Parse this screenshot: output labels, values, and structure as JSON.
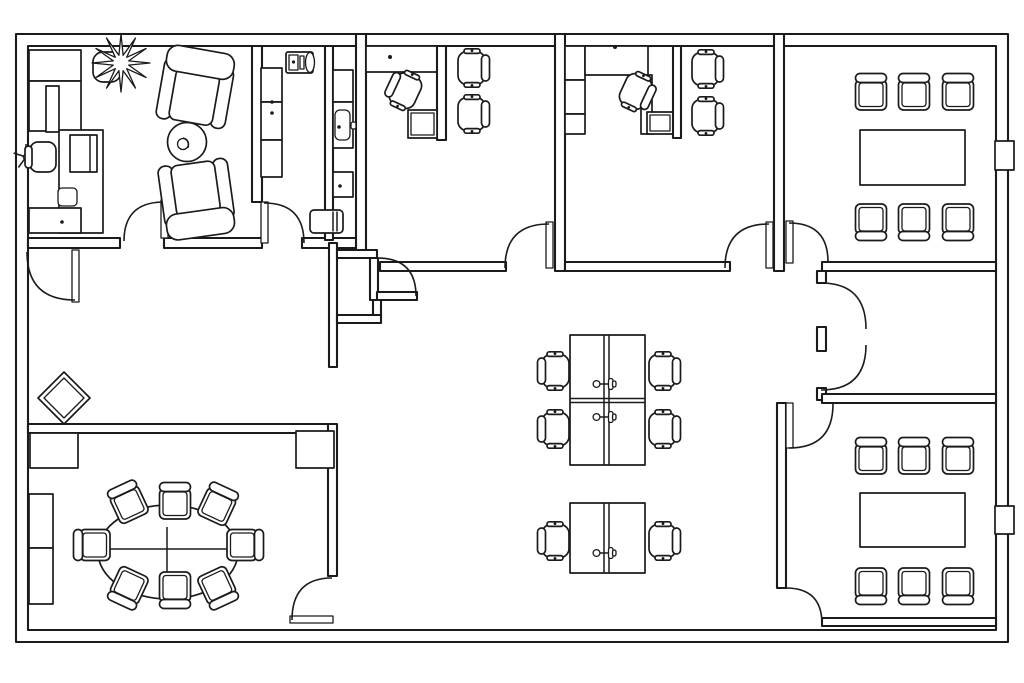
{
  "page": {
    "title": "Office floor plan",
    "type": "architectural-floor-plan",
    "background_color": "#ffffff",
    "line_color": "#1b1b1b",
    "canvas": {
      "width": 1024,
      "height": 683
    }
  },
  "floor_plan": {
    "style": "black and white CAD top-view drawing, hollow double-line walls, quarter-circle door swings",
    "total_doors": 12,
    "rooms": [
      {
        "id": "reception-office",
        "label": "Private office / reception (top-left)",
        "furniture": [
          {
            "type": "storage-cabinet",
            "count": 4
          },
          {
            "type": "reception-desk",
            "count": 1
          },
          {
            "type": "desk-chair-with-star-base",
            "count": 1
          },
          {
            "type": "monitor",
            "count": 1
          },
          {
            "type": "potted-plant",
            "count": 1
          },
          {
            "type": "lounge-armchair",
            "count": 2
          },
          {
            "type": "round-side-table",
            "count": 1
          }
        ],
        "doors": 2
      },
      {
        "id": "kitchenette",
        "label": "Kitchenette (top-middle-left)",
        "furniture": [
          {
            "type": "wall-cabinet",
            "count": 3
          },
          {
            "type": "coffee-machine",
            "count": 1
          },
          {
            "type": "countertop",
            "count": 2
          },
          {
            "type": "sink",
            "count": 1
          },
          {
            "type": "base-cabinet",
            "count": 1
          },
          {
            "type": "waste-bin",
            "count": 1
          }
        ],
        "doors": 1
      },
      {
        "id": "private-office-1",
        "label": "Private office 1 (top-middle)",
        "furniture": [
          {
            "type": "built-in-counter",
            "count": 1
          },
          {
            "type": "l-desk-with-return",
            "count": 1
          },
          {
            "type": "desk-chair",
            "count": 1
          },
          {
            "type": "visitor-chair",
            "count": 2
          },
          {
            "type": "partition",
            "count": 1
          }
        ],
        "doors": 1
      },
      {
        "id": "private-office-2",
        "label": "Private office 2 (top-middle-right)",
        "furniture": [
          {
            "type": "storage-cabinet",
            "count": 3
          },
          {
            "type": "l-desk-with-return",
            "count": 1
          },
          {
            "type": "desk-chair",
            "count": 1
          },
          {
            "type": "visitor-chair",
            "count": 2
          },
          {
            "type": "partition",
            "count": 1
          }
        ],
        "doors": 1
      },
      {
        "id": "meeting-room-top-right",
        "label": "Meeting room (top-right)",
        "furniture": [
          {
            "type": "rectangular-table",
            "count": 1
          },
          {
            "type": "meeting-chair",
            "count": 6
          },
          {
            "type": "wall-niche",
            "count": 1
          }
        ],
        "doors": 1
      },
      {
        "id": "right-vestibule",
        "label": "Vestibule between right meeting rooms",
        "furniture": [],
        "doors": 2,
        "note": "double swing doors opening east"
      },
      {
        "id": "meeting-room-bottom-right",
        "label": "Meeting room (bottom-right)",
        "furniture": [
          {
            "type": "rectangular-table",
            "count": 1
          },
          {
            "type": "meeting-chair",
            "count": 6
          },
          {
            "type": "wall-niche",
            "count": 1
          }
        ],
        "doors": 2
      },
      {
        "id": "conference-room-bottom-left",
        "label": "Conference room (bottom-left)",
        "furniture": [
          {
            "type": "oval-table",
            "count": 1
          },
          {
            "type": "conference-chair",
            "count": 8
          },
          {
            "type": "storage-cabinet",
            "count": 4
          }
        ],
        "doors": 1
      },
      {
        "id": "open-work-area",
        "label": "Central open work area",
        "furniture": [
          {
            "type": "quad-desk-cluster",
            "count": 1,
            "detail": "4 desks, 4 task chairs, 2 monitor arms"
          },
          {
            "type": "double-desk-pod",
            "count": 1,
            "detail": "2 desks, 2 task chairs, 1 monitor arm"
          },
          {
            "type": "rotated-diamond-element",
            "count": 1
          }
        ],
        "doors": 3
      }
    ]
  }
}
